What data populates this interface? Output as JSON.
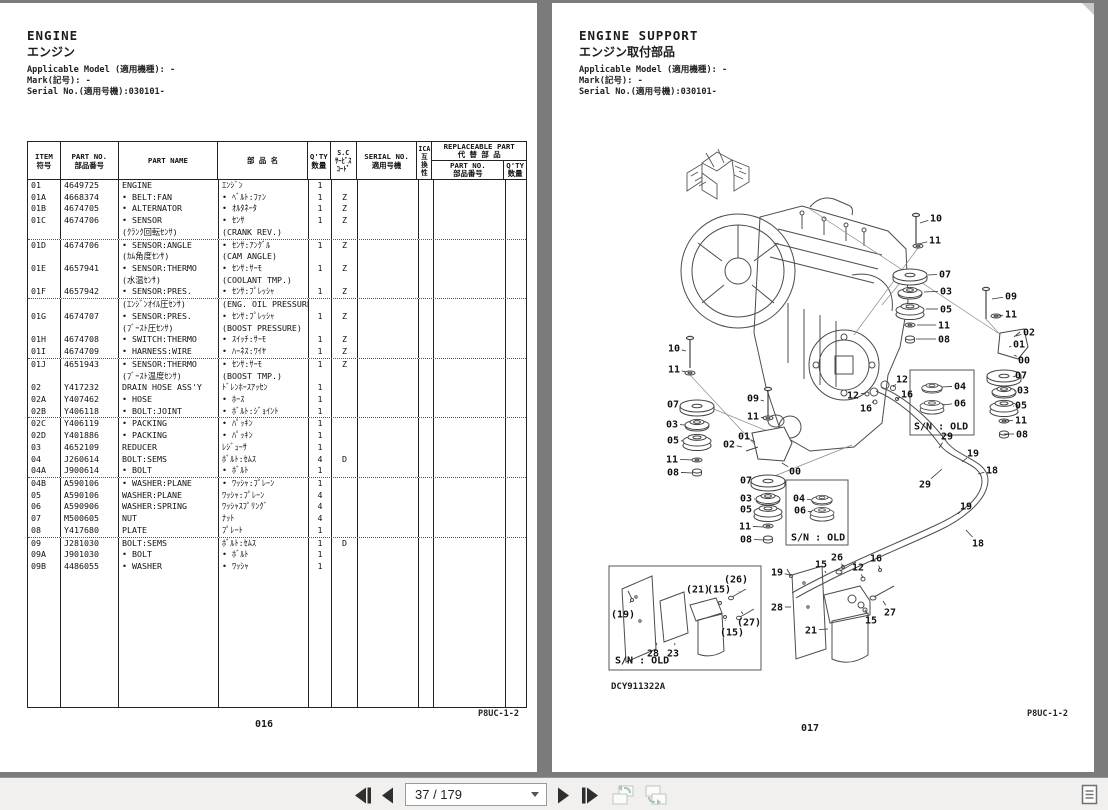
{
  "left_page": {
    "title_en": "ENGINE",
    "title_jp": "エンジン",
    "meta": [
      "Applicable Model (適用機種): -",
      "Mark(記号): -",
      "Serial No.(適用号機):030101-"
    ],
    "doc_code": "P8UC-1-2",
    "page_number": "016",
    "table": {
      "headers": {
        "item": [
          "ITEM",
          "符号"
        ],
        "part_no": [
          "PART NO.",
          "部品番号"
        ],
        "part_name": "PART NAME",
        "part_name_jp": "部 品 名",
        "qty": [
          "Q'TY",
          "数量"
        ],
        "sc": [
          "S.C",
          "ｻｰﾋﾞｽ",
          "ｺｰﾄﾞ"
        ],
        "serial": [
          "SERIAL NO.",
          "適用号機"
        ],
        "ica": [
          "ICA",
          "互",
          "換",
          "性"
        ],
        "replaceable": [
          "REPLACEABLE PART",
          "代 替 部 品"
        ],
        "rep_part_no": [
          "PART NO.",
          "部品番号"
        ],
        "rep_qty": [
          "Q'TY",
          "数量"
        ]
      },
      "rows": [
        [
          "01",
          "4649725",
          "ENGINE",
          "ｴﾝｼﾞﾝ",
          "1",
          ""
        ],
        [
          "01A",
          "4668374",
          "• BELT:FAN",
          "• ﾍﾞﾙﾄ:ﾌｧﾝ",
          "1",
          "Z"
        ],
        [
          "01B",
          "4674705",
          "• ALTERNATOR",
          "• ｵﾙﾀﾈｰﾀ",
          "1",
          "Z"
        ],
        [
          "01C",
          "4674706",
          "• SENSOR",
          "• ｾﾝｻ",
          "1",
          "Z"
        ],
        [
          "",
          "",
          "(ｸﾗﾝｸ回転ｾﾝｻ)",
          "(CRANK REV.)",
          "",
          ""
        ],
        [
          "01D",
          "4674706",
          "• SENSOR:ANGLE",
          "• ｾﾝｻ:ｱﾝｸﾞﾙ",
          "1",
          "Z"
        ],
        [
          "",
          "",
          "(ｶﾑ角度ｾﾝｻ)",
          "(CAM ANGLE)",
          "",
          ""
        ],
        [
          "01E",
          "4657941",
          "• SENSOR:THERMO",
          "• ｾﾝｻ:ｻｰﾓ",
          "1",
          "Z"
        ],
        [
          "",
          "",
          "(水温ｾﾝｻ)",
          "(COOLANT TMP.)",
          "",
          ""
        ],
        [
          "01F",
          "4657942",
          "• SENSOR:PRES.",
          "• ｾﾝｻ:ﾌﾟﾚｯｼｬ",
          "1",
          "Z"
        ],
        [
          "",
          "",
          "(ｴﾝｼﾞﾝｵｲﾙ圧ｾﾝｻ)",
          "(ENG. OIL PRESSURE)",
          "",
          ""
        ],
        [
          "01G",
          "4674707",
          "• SENSOR:PRES.",
          "• ｾﾝｻ:ﾌﾟﾚｯｼｬ",
          "1",
          "Z"
        ],
        [
          "",
          "",
          "(ﾌﾞｰｽﾄ圧ｾﾝｻ)",
          "(BOOST PRESSURE)",
          "",
          ""
        ],
        [
          "01H",
          "4674708",
          "• SWITCH:THERMO",
          "• ｽｲｯﾁ:ｻｰﾓ",
          "1",
          "Z"
        ],
        [
          "01I",
          "4674709",
          "• HARNESS:WIRE",
          "• ﾊｰﾈｽ:ﾜｲﾔ",
          "1",
          "Z"
        ],
        [
          "01J",
          "4651943",
          "• SENSOR:THERMO",
          "• ｾﾝｻ:ｻｰﾓ",
          "1",
          "Z"
        ],
        [
          "",
          "",
          "(ﾌﾞｰｽﾄ温度ｾﾝｻ)",
          "(BOOST TMP.)",
          "",
          ""
        ],
        [
          "02",
          "Y417232",
          "DRAIN HOSE ASS'Y",
          "ﾄﾞﾚﾝﾎｰｽｱｯｾﾝ",
          "1",
          ""
        ],
        [
          "02A",
          "Y407462",
          "• HOSE",
          "• ﾎｰｽ",
          "1",
          ""
        ],
        [
          "02B",
          "Y406118",
          "• BOLT:JOINT",
          "• ﾎﾞﾙﾄ:ｼﾞｮｲﾝﾄ",
          "1",
          ""
        ],
        [
          "02C",
          "Y406119",
          "• PACKING",
          "• ﾊﾟｯｷﾝ",
          "1",
          ""
        ],
        [
          "02D",
          "Y401886",
          "• PACKING",
          "• ﾊﾟｯｷﾝ",
          "1",
          ""
        ],
        [
          "03",
          "4652109",
          "REDUCER",
          "ﾚｼﾞｭｰｻ",
          "1",
          ""
        ],
        [
          "04",
          "J260614",
          "BOLT:SEMS",
          "ﾎﾞﾙﾄ:ｾﾑｽ",
          "4",
          "D"
        ],
        [
          "04A",
          "J900614",
          "• BOLT",
          "• ﾎﾞﾙﾄ",
          "1",
          ""
        ],
        [
          "04B",
          "A590106",
          "• WASHER:PLANE",
          "• ﾜｯｼｬ:ﾌﾟﾚｰﾝ",
          "1",
          ""
        ],
        [
          "05",
          "A590106",
          "WASHER:PLANE",
          "ﾜｯｼｬ:ﾌﾟﾚｰﾝ",
          "4",
          ""
        ],
        [
          "06",
          "A590906",
          "WASHER:SPRING",
          "ﾜｯｼｬｽﾌﾟﾘﾝｸﾞ",
          "4",
          ""
        ],
        [
          "07",
          "M500605",
          "NUT",
          "ﾅｯﾄ",
          "4",
          ""
        ],
        [
          "08",
          "Y417680",
          "PLATE",
          "ﾌﾟﾚｰﾄ",
          "1",
          ""
        ],
        [
          "09",
          "J281030",
          "BOLT:SEMS",
          "ﾎﾞﾙﾄ:ｾﾑｽ",
          "1",
          "D"
        ],
        [
          "09A",
          "J901030",
          "• BOLT",
          "• ﾎﾞﾙﾄ",
          "1",
          ""
        ],
        [
          "09B",
          "4486055",
          "• WASHER",
          "• ﾜｯｼｬ",
          "1",
          ""
        ]
      ],
      "dotted_after": [
        4,
        9,
        14,
        19,
        24,
        29
      ]
    }
  },
  "right_page": {
    "title_en": "ENGINE SUPPORT",
    "title_jp": "エンジン取付部品",
    "meta": [
      "Applicable Model (適用機種): -",
      "Mark(記号): -",
      "Serial No.(適用号機):030101-"
    ],
    "figure_code": "DCY911322A",
    "doc_code": "P8UC-1-2",
    "page_number": "017",
    "diagram": {
      "callouts": [
        {
          "t": "10",
          "x": 384,
          "y": 215,
          "lx": 368,
          "ly": 220
        },
        {
          "t": "11",
          "x": 383,
          "y": 237,
          "lx": 366,
          "ly": 241
        },
        {
          "t": "07",
          "x": 393,
          "y": 271,
          "lx": 376,
          "ly": 272
        },
        {
          "t": "03",
          "x": 394,
          "y": 288,
          "lx": 372,
          "ly": 289
        },
        {
          "t": "05",
          "x": 394,
          "y": 306,
          "lx": 374,
          "ly": 306
        },
        {
          "t": "11",
          "x": 392,
          "y": 322,
          "lx": 365,
          "ly": 322
        },
        {
          "t": "08",
          "x": 392,
          "y": 336,
          "lx": 364,
          "ly": 336
        },
        {
          "t": "09",
          "x": 459,
          "y": 293,
          "lx": 440,
          "ly": 296
        },
        {
          "t": "11",
          "x": 459,
          "y": 311,
          "lx": 446,
          "ly": 313
        },
        {
          "t": "02",
          "x": 477,
          "y": 329,
          "lx": 464,
          "ly": 333
        },
        {
          "t": "01",
          "x": 467,
          "y": 341,
          "lx": 457,
          "ly": 344
        },
        {
          "t": "00",
          "x": 472,
          "y": 357,
          "lx": 462,
          "ly": 352
        },
        {
          "t": "07",
          "x": 469,
          "y": 372,
          "lx": 464,
          "ly": 373
        },
        {
          "t": "03",
          "x": 471,
          "y": 387,
          "lx": 462,
          "ly": 388
        },
        {
          "t": "05",
          "x": 469,
          "y": 402,
          "lx": 462,
          "ly": 403
        },
        {
          "t": "11",
          "x": 469,
          "y": 417,
          "lx": 453,
          "ly": 418
        },
        {
          "t": "08",
          "x": 470,
          "y": 431,
          "lx": 452,
          "ly": 431
        },
        {
          "t": "10",
          "x": 122,
          "y": 345,
          "lx": 134,
          "ly": 348
        },
        {
          "t": "11",
          "x": 122,
          "y": 366,
          "lx": 134,
          "ly": 369
        },
        {
          "t": "07",
          "x": 121,
          "y": 401,
          "lx": 129,
          "ly": 403
        },
        {
          "t": "03",
          "x": 120,
          "y": 421,
          "lx": 133,
          "ly": 422
        },
        {
          "t": "05",
          "x": 121,
          "y": 437,
          "lx": 131,
          "ly": 438
        },
        {
          "t": "11",
          "x": 120,
          "y": 456,
          "lx": 140,
          "ly": 457
        },
        {
          "t": "08",
          "x": 121,
          "y": 469,
          "lx": 140,
          "ly": 470
        },
        {
          "t": "09",
          "x": 201,
          "y": 395,
          "lx": 212,
          "ly": 398
        },
        {
          "t": "11",
          "x": 201,
          "y": 413,
          "lx": 212,
          "ly": 415
        },
        {
          "t": "02",
          "x": 177,
          "y": 441,
          "lx": 190,
          "ly": 444
        },
        {
          "t": "01",
          "x": 192,
          "y": 433,
          "lx": 203,
          "ly": 439
        },
        {
          "t": "00",
          "x": 243,
          "y": 468,
          "lx": 230,
          "ly": 460
        },
        {
          "t": "07",
          "x": 194,
          "y": 477,
          "lx": 202,
          "ly": 478
        },
        {
          "t": "03",
          "x": 194,
          "y": 495,
          "lx": 203,
          "ly": 496
        },
        {
          "t": "05",
          "x": 194,
          "y": 506,
          "lx": 202,
          "ly": 508
        },
        {
          "t": "11",
          "x": 193,
          "y": 523,
          "lx": 211,
          "ly": 524
        },
        {
          "t": "08",
          "x": 194,
          "y": 536,
          "lx": 211,
          "ly": 537
        },
        {
          "t": "04",
          "x": 247,
          "y": 495,
          "lx": 260,
          "ly": 497
        },
        {
          "t": "06",
          "x": 248,
          "y": 507,
          "lx": 260,
          "ly": 509
        },
        {
          "t": "S/N : OLD",
          "x": 239,
          "y": 534,
          "a": "s"
        },
        {
          "t": "04",
          "x": 408,
          "y": 383,
          "lx": 390,
          "ly": 384
        },
        {
          "t": "06",
          "x": 408,
          "y": 400,
          "lx": 390,
          "ly": 402
        },
        {
          "t": "S/N : OLD",
          "x": 362,
          "y": 423,
          "a": "s"
        },
        {
          "t": "29",
          "x": 395,
          "y": 433,
          "lx": 387,
          "ly": 445
        },
        {
          "t": "29",
          "x": 373,
          "y": 481,
          "lx": 390,
          "ly": 466
        },
        {
          "t": "19",
          "x": 421,
          "y": 450,
          "lx": 410,
          "ly": 459
        },
        {
          "t": "18",
          "x": 440,
          "y": 467,
          "lx": 426,
          "ly": 471
        },
        {
          "t": "19",
          "x": 414,
          "y": 503,
          "lx": 406,
          "ly": 511
        },
        {
          "t": "18",
          "x": 426,
          "y": 540,
          "lx": 414,
          "ly": 527
        },
        {
          "t": "12",
          "x": 350,
          "y": 376,
          "lx": 341,
          "ly": 384
        },
        {
          "t": "12",
          "x": 301,
          "y": 392,
          "lx": 314,
          "ly": 390
        },
        {
          "t": "16",
          "x": 355,
          "y": 391,
          "lx": 345,
          "ly": 396
        },
        {
          "t": "16",
          "x": 314,
          "y": 405,
          "lx": 322,
          "ly": 398
        },
        {
          "t": "19",
          "x": 225,
          "y": 569,
          "lx": 238,
          "ly": 572
        },
        {
          "t": "15",
          "x": 269,
          "y": 561,
          "lx": 274,
          "ly": 570
        },
        {
          "t": "26",
          "x": 285,
          "y": 554,
          "lx": 291,
          "ly": 563
        },
        {
          "t": "12",
          "x": 306,
          "y": 564,
          "lx": 311,
          "ly": 575
        },
        {
          "t": "16",
          "x": 324,
          "y": 555,
          "lx": 328,
          "ly": 566
        },
        {
          "t": "28",
          "x": 225,
          "y": 604,
          "lx": 239,
          "ly": 604
        },
        {
          "t": "21",
          "x": 259,
          "y": 627,
          "lx": 276,
          "ly": 626
        },
        {
          "t": "15",
          "x": 319,
          "y": 617,
          "lx": 313,
          "ly": 607
        },
        {
          "t": "27",
          "x": 338,
          "y": 609,
          "lx": 331,
          "ly": 598
        },
        {
          "t": "(19)",
          "x": 71,
          "y": 611,
          "lx": 79,
          "ly": 598
        },
        {
          "t": "(21)",
          "x": 146,
          "y": 586,
          "lx": 150,
          "ly": 598
        },
        {
          "t": "(15)",
          "x": 167,
          "y": 586,
          "lx": 168,
          "ly": 598
        },
        {
          "t": "(26)",
          "x": 184,
          "y": 576,
          "lx": 187,
          "ly": 588
        },
        {
          "t": "(27)",
          "x": 197,
          "y": 619,
          "lx": 191,
          "ly": 611
        },
        {
          "t": "(15)",
          "x": 180,
          "y": 629,
          "lx": 173,
          "ly": 617
        },
        {
          "t": "28",
          "x": 101,
          "y": 650,
          "lx": 105,
          "ly": 640
        },
        {
          "t": "23",
          "x": 121,
          "y": 650,
          "lx": 123,
          "ly": 640
        },
        {
          "t": "S/N : OLD",
          "x": 63,
          "y": 657,
          "a": "s"
        }
      ]
    }
  },
  "toolbar": {
    "page_indicator": "37 / 179"
  }
}
